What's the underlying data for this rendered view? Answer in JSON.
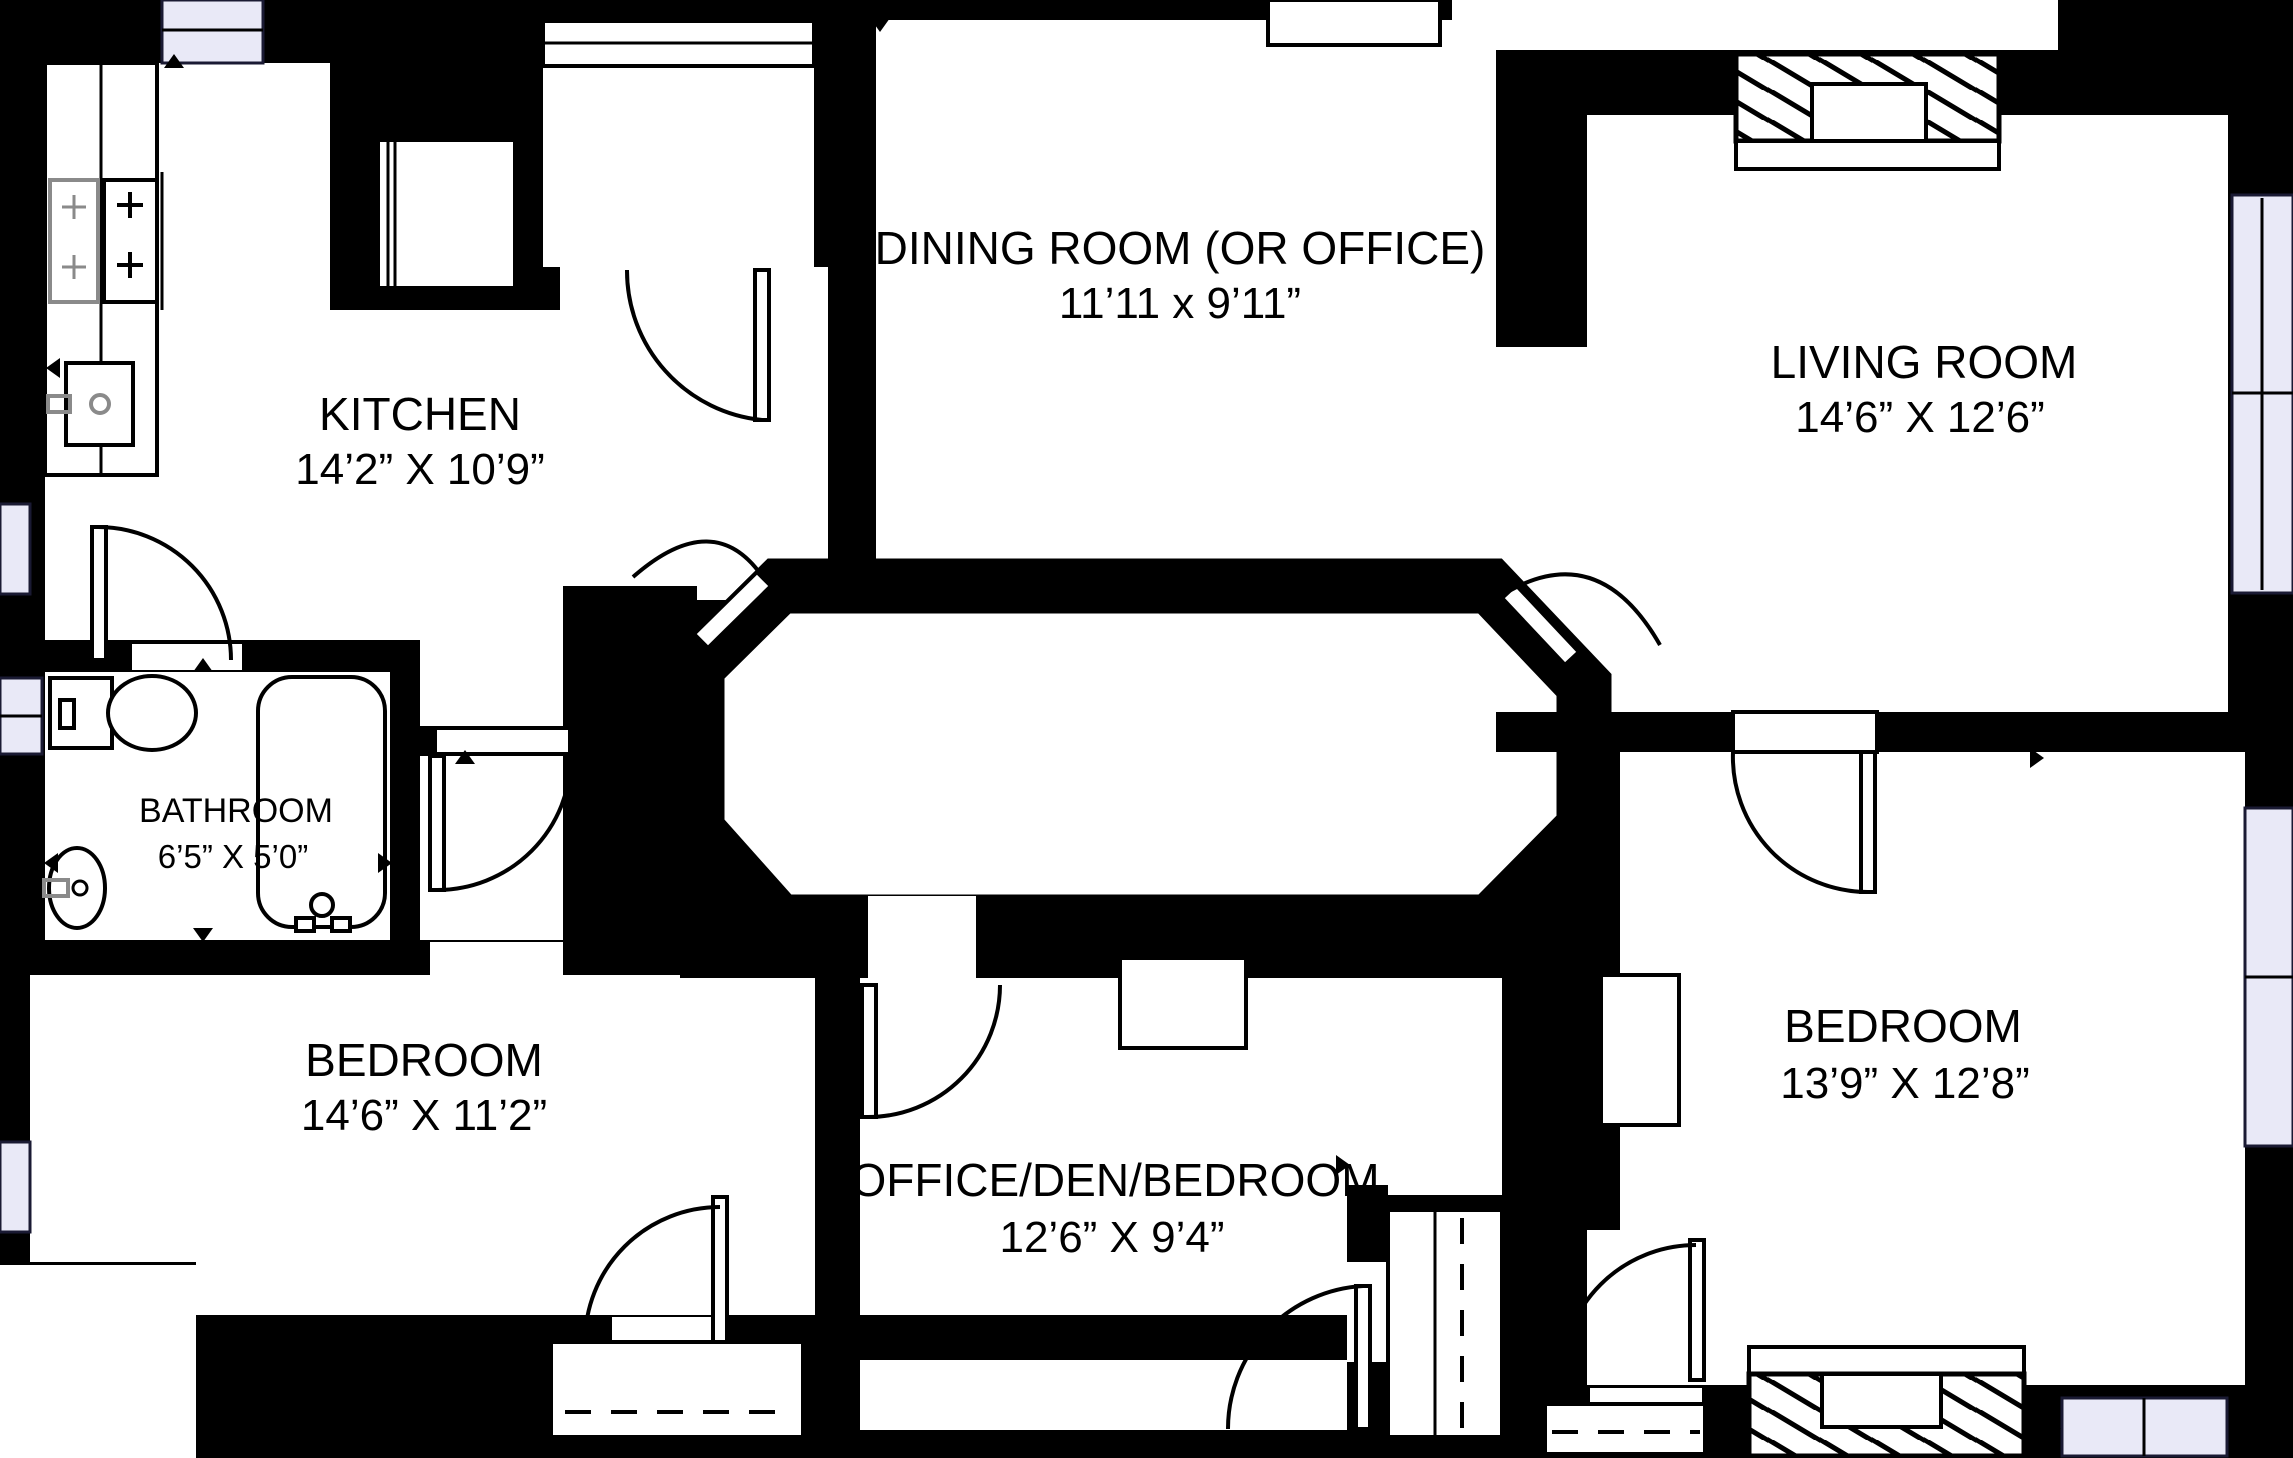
{
  "floorplan": {
    "type": "apartment-floor-plan",
    "colors": {
      "wall": "#000000",
      "floor": "#ffffff",
      "window_glass": "#e9e9f7",
      "fixture_gray": "#8a8a8a"
    },
    "rooms": [
      {
        "id": "kitchen",
        "name": "KITCHEN",
        "dimensions": "14’2” X 10’9”"
      },
      {
        "id": "dining-room",
        "name": "DINING ROOM (OR OFFICE)",
        "dimensions": "11’11 x 9’11”"
      },
      {
        "id": "living-room",
        "name": "LIVING ROOM",
        "dimensions": "14’6” X 12’6”"
      },
      {
        "id": "bathroom",
        "name": "BATHROOM",
        "dimensions": "6’5” X 5’0”"
      },
      {
        "id": "bedroom-left",
        "name": "BEDROOM",
        "dimensions": "14’6” X 11’2”"
      },
      {
        "id": "office-den",
        "name": "OFFICE/DEN/BEDROOM",
        "dimensions": "12’6” X 9’4”"
      },
      {
        "id": "bedroom-right",
        "name": "BEDROOM",
        "dimensions": "13’9” X 12’8”"
      }
    ],
    "fixtures": [
      "stove-icon",
      "kitchen-sink-icon",
      "refrigerator-icon",
      "toilet-icon",
      "vanity-sink-icon",
      "bathtub-icon",
      "fireplace-icon-living-room",
      "fireplace-icon-bedroom",
      "closet-rod-dashed",
      "door-swing",
      "window"
    ]
  }
}
